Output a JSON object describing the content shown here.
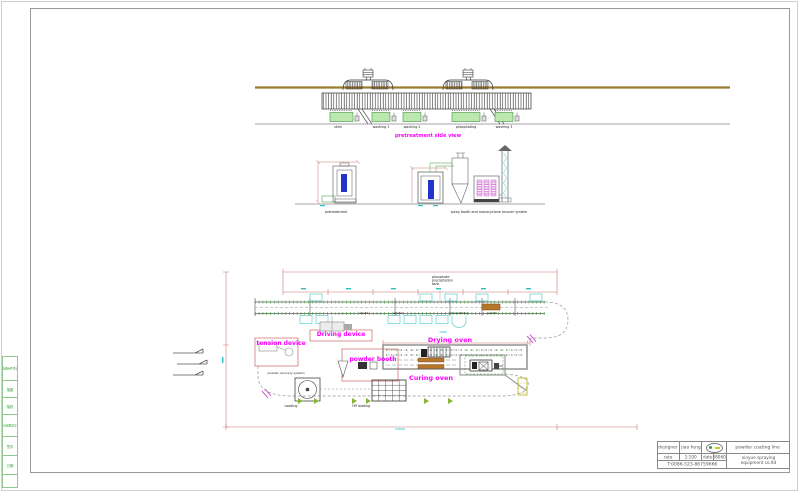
{
  "colors": {
    "magenta_label": "#ff00ff",
    "dimension_red": "#cc7777",
    "dimension_cyan": "#00b7b7",
    "tank_green": "#bce8b0",
    "part_blue": "#2233cc",
    "oven_orange": "#b5762a",
    "ground_brown": "#9a7b2e",
    "strip_green": "#2e9e2e"
  },
  "side_view": {
    "title": "pretreatment side view",
    "tanks": [
      "skim",
      "washing 1",
      "washing 2",
      "phosphating",
      "washing 3"
    ]
  },
  "section_view": {
    "pretreatment_label": "pretreatment",
    "booth_label": "spray booth and monocyclone recover system"
  },
  "plan_view": {
    "note_line1": "phosphate",
    "note_line2": "precipitation",
    "note_line3": "tank",
    "stage_labels": [
      "wash1",
      "wash2",
      "phosphating",
      "wash3"
    ],
    "driving_device": "Driving device",
    "tension_device": "tension device",
    "powder_booth": "powder booth",
    "powder_recovery": "powder recovery system",
    "drying_oven": "Drying oven",
    "curing_oven": "Curing oven",
    "loading": "Loading",
    "off_loading": "Off loading",
    "dim_oven": "7000",
    "dim_total": "27000"
  },
  "left_strip": {
    "cells": [
      "借通用件登记",
      "描图",
      "描校",
      "旧底图总号",
      "签字",
      "日期"
    ]
  },
  "title_block": {
    "designer_label": "designer",
    "designer_name": "jiao feng",
    "scale_label": "rate",
    "scale_value": "1:100",
    "date_label": "date",
    "date_value": "080607",
    "phone": "T:0086-523-86759666",
    "project": "powder coating line",
    "company_line1": "xinyue spraying",
    "company_line2": "equipment co.ltd"
  }
}
